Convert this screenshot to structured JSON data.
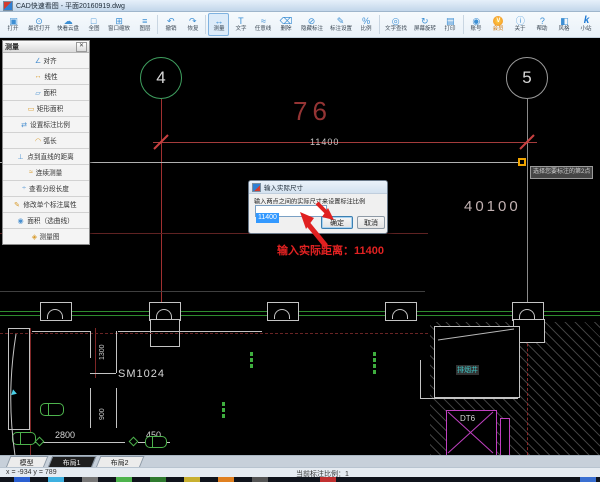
{
  "window": {
    "title": "CAD快速看图 - 平面20160919.dwg"
  },
  "toolbar": {
    "items": [
      {
        "label": "打开",
        "icon": "open-icon",
        "glyph": "▣"
      },
      {
        "label": "最近打开",
        "icon": "recent-open-icon",
        "glyph": "⊙"
      },
      {
        "label": "快看云盘",
        "icon": "cloud-disk-icon",
        "glyph": "☁"
      },
      {
        "label": "全图",
        "icon": "full-view-icon",
        "glyph": "□"
      },
      {
        "label": "窗口缩放",
        "icon": "window-zoom-icon",
        "glyph": "⊞"
      },
      {
        "label": "图层",
        "icon": "layers-icon",
        "glyph": "≡"
      },
      {
        "label": "撤销",
        "icon": "undo-icon",
        "glyph": "↶"
      },
      {
        "label": "恢复",
        "icon": "redo-icon",
        "glyph": "↷"
      },
      {
        "label": "测量",
        "icon": "measure-icon",
        "glyph": "↔",
        "selected": true
      },
      {
        "label": "文字",
        "icon": "text-icon",
        "glyph": "T"
      },
      {
        "label": "任意线",
        "icon": "free-line-icon",
        "glyph": "≈"
      },
      {
        "label": "删除",
        "icon": "delete-icon",
        "glyph": "⌫"
      },
      {
        "label": "隐藏标注",
        "icon": "hide-annotation-icon",
        "glyph": "⊘"
      },
      {
        "label": "标注设置",
        "icon": "annotation-settings-icon",
        "glyph": "✎"
      },
      {
        "label": "比例",
        "icon": "scale-icon",
        "glyph": "%"
      },
      {
        "label": "文字查找",
        "icon": "text-search-icon",
        "glyph": "◎"
      },
      {
        "label": "屏幕旋转",
        "icon": "screen-rotate-icon",
        "glyph": "↻"
      },
      {
        "label": "打印",
        "icon": "print-icon",
        "glyph": "▤"
      },
      {
        "label": "账号",
        "icon": "account-icon",
        "glyph": "◉"
      },
      {
        "label": "会员",
        "icon": "vip-icon",
        "glyph": "V"
      },
      {
        "label": "关于",
        "icon": "about-icon",
        "glyph": "ⓘ"
      },
      {
        "label": "帮助",
        "icon": "help-icon",
        "glyph": "?"
      },
      {
        "label": "风格",
        "icon": "style-icon",
        "glyph": "◧"
      },
      {
        "label": "小站",
        "icon": "site-icon",
        "glyph": "k"
      }
    ]
  },
  "measure_panel": {
    "title": "测量",
    "close_glyph": "✕",
    "items": [
      {
        "label": "对齐",
        "icon": "align-dimension-icon",
        "glyph": "∠"
      },
      {
        "label": "线性",
        "icon": "linear-dimension-icon",
        "glyph": "↔"
      },
      {
        "label": "面积",
        "icon": "area-icon",
        "glyph": "▱"
      },
      {
        "label": "矩形面积",
        "icon": "rect-area-icon",
        "glyph": "▭"
      },
      {
        "label": "设置标注比例",
        "icon": "set-scale-icon",
        "glyph": "⇄"
      },
      {
        "label": "弧长",
        "icon": "arc-length-icon",
        "glyph": "◠"
      },
      {
        "label": "点到直线的距离",
        "icon": "point-to-line-icon",
        "glyph": "⊥"
      },
      {
        "label": "连续测量",
        "icon": "continuous-measure-icon",
        "glyph": "≈"
      },
      {
        "label": "查看分段长度",
        "icon": "segment-length-icon",
        "glyph": "÷"
      },
      {
        "label": "修改单个标注属性",
        "icon": "edit-annotation-icon",
        "glyph": "✎"
      },
      {
        "label": "面积（选曲线）",
        "icon": "area-curve-icon",
        "glyph": "◉"
      },
      {
        "label": "测量图",
        "icon": "measure-map-icon",
        "glyph": "◈"
      }
    ]
  },
  "canvas": {
    "axis_bubble_left": "4",
    "axis_bubble_right": "5",
    "dim_value": "76",
    "dim_label": "11400",
    "area_value": "40100",
    "snap_tooltip": "选择您要标注的第2点",
    "hint_text": "输入实际距离：11400",
    "plan": {
      "room": "SM1024",
      "shaft": "排烟井",
      "elevator": "DT6",
      "dim_1300": "1300",
      "dim_900": "900",
      "dim_2800": "2800",
      "dim_450": "450"
    }
  },
  "dialog": {
    "title": "输入实际尺寸",
    "message": "输入两点之间的实际尺寸来设置标注比例",
    "input_value": "11400",
    "ok_label": "确定",
    "cancel_label": "取消"
  },
  "layout_tabs": [
    {
      "label": "模型"
    },
    {
      "label": "布局1",
      "active": true
    },
    {
      "label": "布局2"
    }
  ],
  "status_bar": {
    "coordinates": "x = -934 y = 789",
    "scale_info": "当前标注比例：1"
  },
  "colors": {
    "dim_red": "#a53c3c",
    "hint_red": "#e22222",
    "axis_green": "#3f9f5f",
    "plan_green": "#2e8b2e",
    "magenta": "#c040c0",
    "cyan": "#3ec6c6",
    "snap_yellow": "#f0a400",
    "toolbar_icon_blue": "#3d8fd4",
    "vip_orange": "#f08a1d"
  }
}
